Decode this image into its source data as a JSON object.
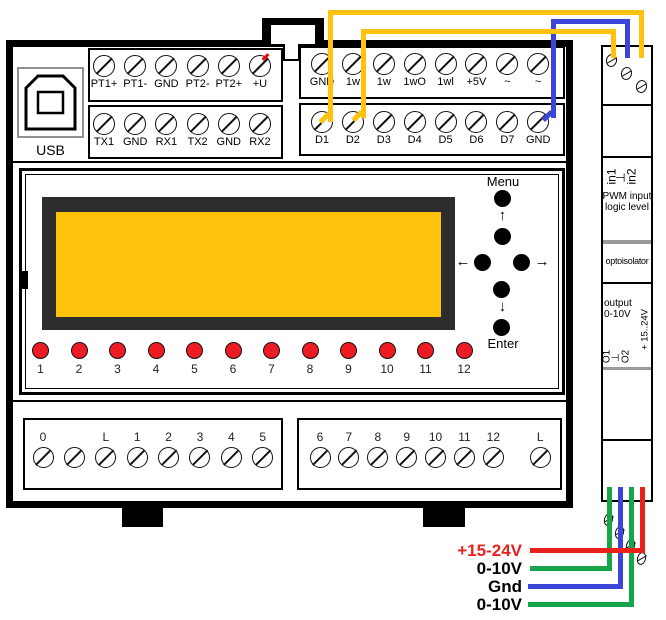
{
  "usb": {
    "label": "USB"
  },
  "keypad": {
    "menu": "Menu",
    "enter": "Enter",
    "up": "↑",
    "down": "↓",
    "left": "←",
    "right": "→"
  },
  "terminal_rows": {
    "pt": [
      "PT1+",
      "PT1-",
      "GND",
      "PT2-",
      "PT2+",
      "+U"
    ],
    "serial": [
      "TX1",
      "GND",
      "RX1",
      "TX2",
      "GND",
      "RX2"
    ],
    "onewire": [
      "GND",
      "1w",
      "1w",
      "1wO",
      "1wl",
      "+5V",
      "~",
      "~"
    ],
    "digital": [
      "D1",
      "D2",
      "D3",
      "D4",
      "D5",
      "D6",
      "D7",
      "GND"
    ],
    "bottom_left": [
      "0",
      "",
      "L",
      "1",
      "2",
      "3",
      "4",
      "5"
    ],
    "bottom_right": [
      "6",
      "7",
      "8",
      "9",
      "10",
      "11",
      "12",
      "L"
    ]
  },
  "leds": [
    "1",
    "2",
    "3",
    "4",
    "5",
    "6",
    "7",
    "8",
    "9",
    "10",
    "11",
    "12"
  ],
  "side_module": {
    "input_terminals": [
      "in1",
      "⊥",
      "in2"
    ],
    "pwm_line1": "PWM input",
    "pwm_line2": "logic level",
    "optoisolator": "optoisolator",
    "output_line1": "output",
    "output_line2": "0-10V",
    "supply_rotated": "+ 15..24V",
    "output_terminals": [
      "O1",
      "⊥",
      "O2"
    ]
  },
  "wiring": {
    "labels": [
      {
        "text": "+15-24V",
        "color": "#e8211d"
      },
      {
        "text": "0-10V",
        "color": "#000000"
      },
      {
        "text": "Gnd",
        "color": "#000000"
      },
      {
        "text": "0-10V",
        "color": "#000000"
      }
    ],
    "colors": {
      "yellow": "#ffc20e",
      "blue": "#3b46d9",
      "green": "#17a54a",
      "red": "#e8211d"
    }
  },
  "lcd": {
    "screen_color": "#fdc30b",
    "frame_color": "#2d2d2d"
  }
}
